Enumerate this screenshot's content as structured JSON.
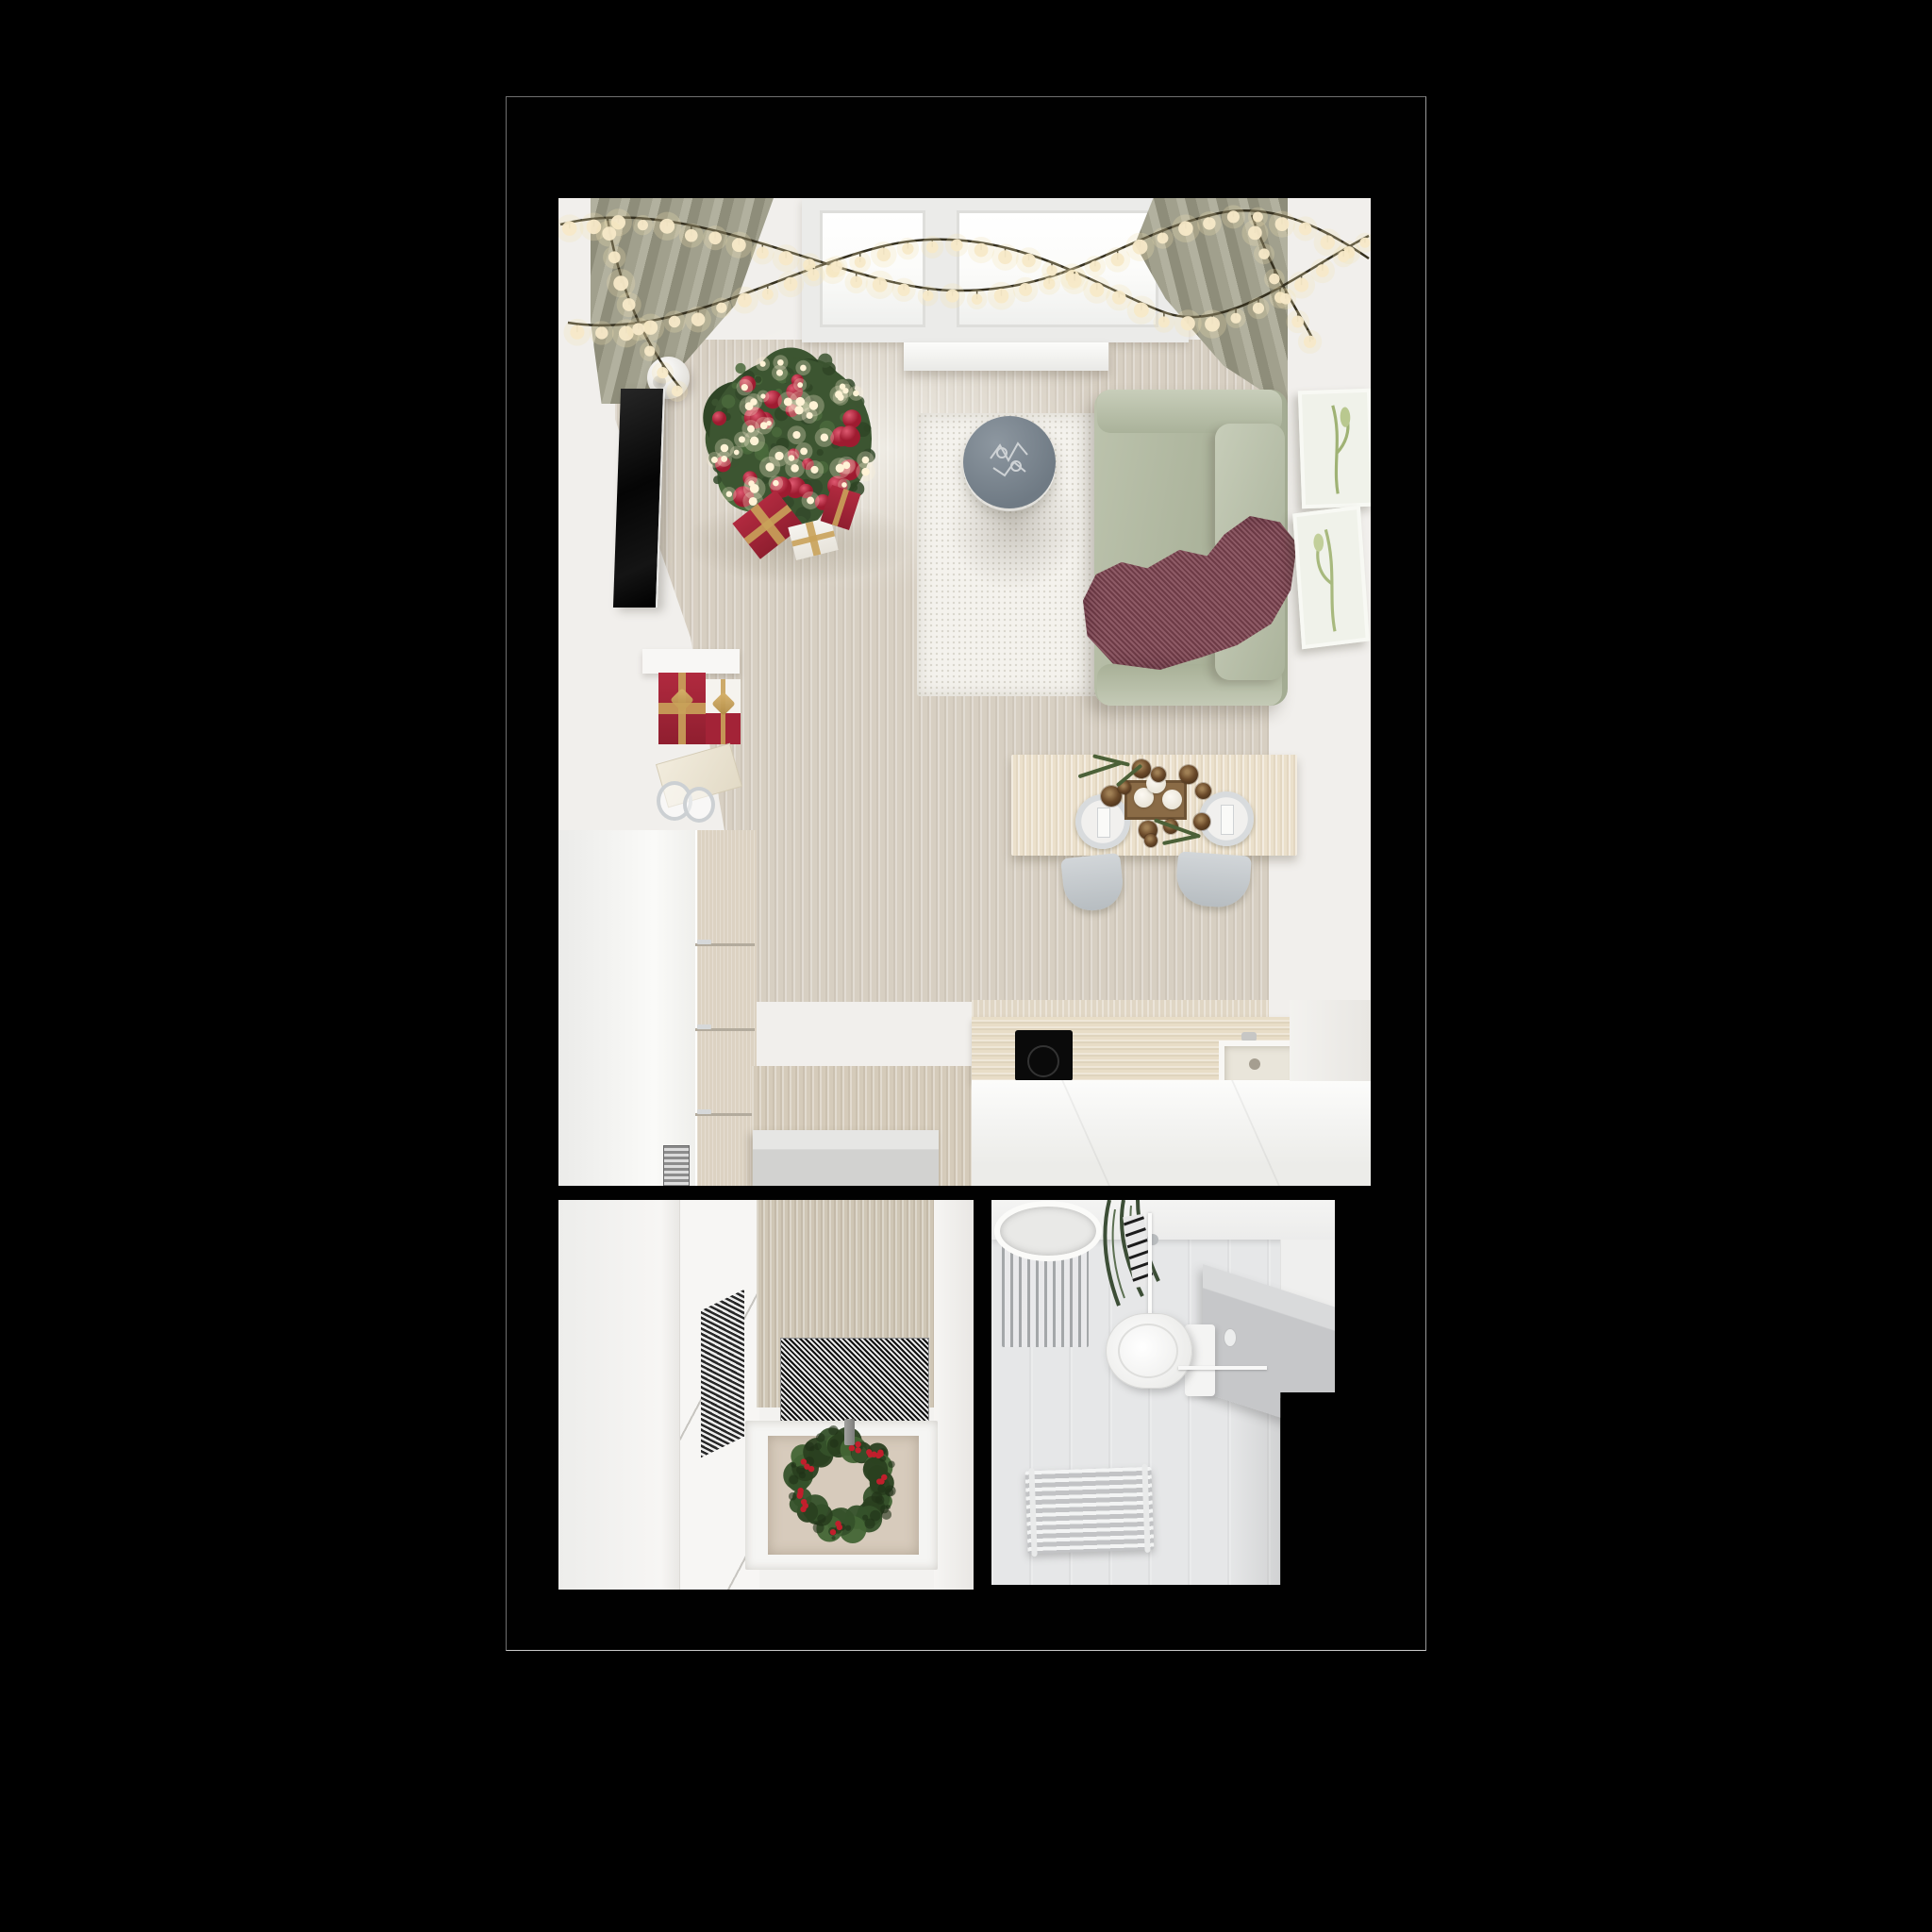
{
  "scene": {
    "type": "top-down 3D render of a studio apartment decorated for Christmas",
    "background": "#000000",
    "rooms": [
      {
        "name": "living-room",
        "items": [
          "window",
          "curtains",
          "string-lights",
          "christmas-tree",
          "gift-boxes",
          "tv",
          "wall-lamp",
          "dresser",
          "entry-bench",
          "kitchen-counter",
          "cooktop",
          "sink",
          "rug",
          "coffee-table",
          "sofa",
          "throw-blanket",
          "wall-art",
          "dining-table",
          "plates",
          "candles",
          "pinecones",
          "chairs"
        ]
      },
      {
        "name": "hallway",
        "items": [
          "wardrobe",
          "door",
          "tweed-mat",
          "floor-recess",
          "christmas-wreath",
          "wreath-candle"
        ]
      },
      {
        "name": "bathroom",
        "items": [
          "sink",
          "striped-mat",
          "hanging-garland",
          "toilet",
          "counter",
          "grab-rail",
          "towel-radiator"
        ]
      }
    ]
  },
  "palette": {
    "frame_border": "#6f6f6f",
    "wall": "#f1efec",
    "floor": "#d7cfc2",
    "curtain": "#a1a08d",
    "sofa": "#b2baa2",
    "throw": "#7c4350",
    "rug": "#f4f2ed",
    "table_wood": "#ebe0cb",
    "counter_wood": "#e8ddc7",
    "tree_greens": [
      "#3c5531",
      "#2f4526",
      "#4a6a3c",
      "#33492a"
    ],
    "wreath_greens": [
      "#35512a",
      "#2a4020",
      "#436535"
    ],
    "ball_red_light": "#de5970",
    "ball_red_dark": "#9e1b30",
    "berry_red": "#c11f2c",
    "light_warm": "#fff3d6",
    "bulb": "#f7e9c8",
    "bulb_halo": "#f3e3b5",
    "wire": "#35301f",
    "coffee_table": "#6f7a84",
    "chair": "#c7ccd0",
    "bath_floor": "#e6e7e8"
  },
  "counts": {
    "tree_tufts": 72,
    "tree_balls": 26,
    "tree_lights": 48,
    "wreath_tufts": 36,
    "berry_clusters": 8,
    "bulb_spacing_px": 26
  }
}
